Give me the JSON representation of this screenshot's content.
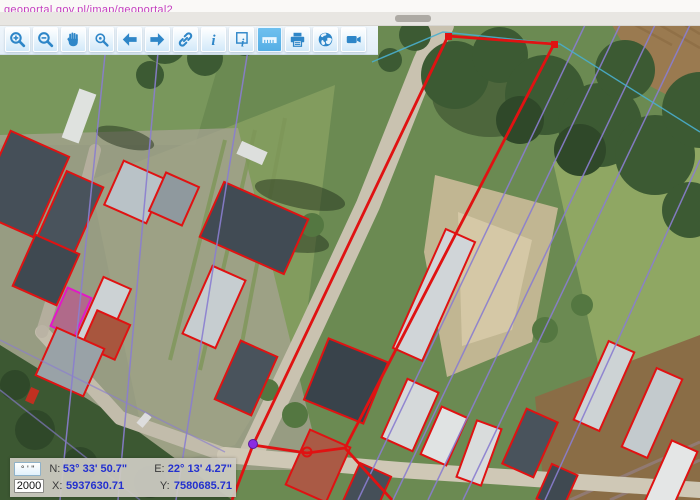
{
  "page": {
    "url_link_text": "geoportal.gov.pl/imap/geoportal2"
  },
  "toolbar": {
    "buttons": [
      {
        "name": "zoom-in",
        "icon": "zoom-in-icon",
        "active": false
      },
      {
        "name": "zoom-out",
        "icon": "zoom-out-icon",
        "active": false
      },
      {
        "name": "pan",
        "icon": "hand-icon",
        "active": false
      },
      {
        "name": "zoom-selection",
        "icon": "magnifier-select-icon",
        "active": false
      },
      {
        "name": "previous-view",
        "icon": "arrow-left-icon",
        "active": false
      },
      {
        "name": "next-view",
        "icon": "arrow-right-icon",
        "active": false
      },
      {
        "name": "share-link",
        "icon": "link-icon",
        "active": false
      },
      {
        "name": "info",
        "icon": "info-icon",
        "active": false
      },
      {
        "name": "identify",
        "icon": "identify-icon",
        "active": false
      },
      {
        "name": "measure",
        "icon": "ruler-icon",
        "active": true
      },
      {
        "name": "print",
        "icon": "printer-icon",
        "active": false
      },
      {
        "name": "web-services",
        "icon": "globe-icon",
        "active": false
      },
      {
        "name": "video",
        "icon": "camera-icon",
        "active": false
      }
    ]
  },
  "statusbar": {
    "dms_button": "° ' \"",
    "scale": "2000",
    "n_label": "N:",
    "n_value": "53° 33' 50.7\"",
    "e_label": "E:",
    "e_value": "22° 13' 4.27\"",
    "x_label": "X:",
    "x_value": "5937630.71",
    "y_label": "Y:",
    "y_value": "7580685.71"
  },
  "colors": {
    "accent_blue": "#2e86c8",
    "active_button": "#55aee5",
    "parcel_red": "#e01212",
    "selection_magenta": "#e318c8",
    "boundary_purple": "#8a7ed0",
    "boundary_teal": "#49aecd",
    "coord_value_blue": "#2330cf",
    "link_magenta": "#c43fc0",
    "vertex_purple": "#8a2be2"
  }
}
